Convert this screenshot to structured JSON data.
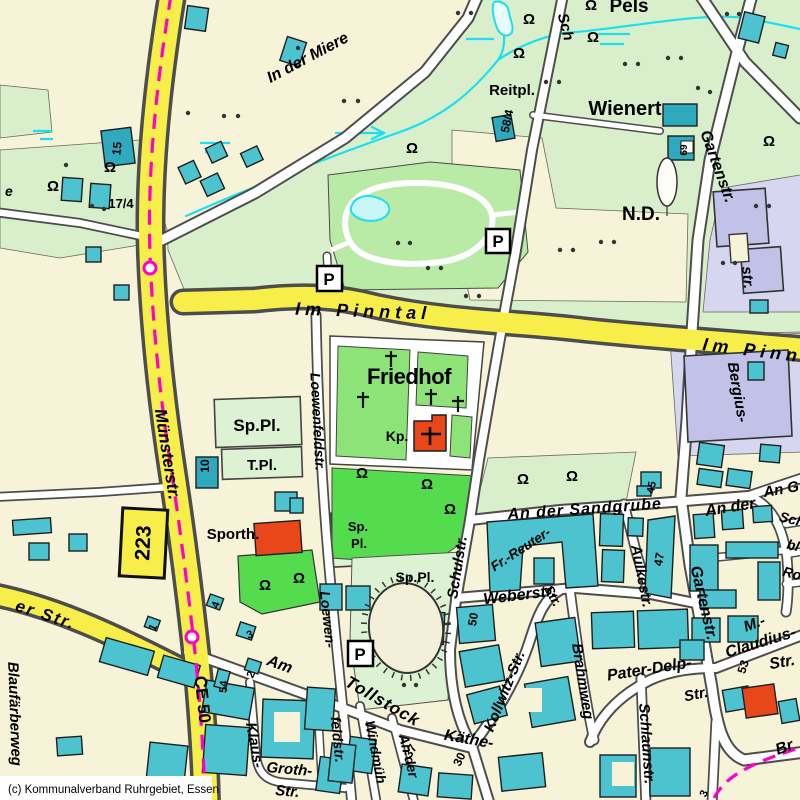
{
  "map": {
    "copyright": "(c) Kommunalverband Ruhrgebiet, Essen",
    "routes": {
      "b223": "223",
      "ce50": "CE 50"
    },
    "icons": {
      "parking": "P",
      "tree": "Ω"
    },
    "colors": {
      "cream": "#f7f3d8",
      "pale_green": "#d9efcb",
      "park_green": "#b9eaa6",
      "mid_green": "#8de378",
      "bright_green": "#55dc4e",
      "teal_building": "#4cc3ce",
      "teal_dark": "#2ea9bd",
      "lavender_area": "#d6d6f0",
      "lavender_building": "#c2c2e8",
      "yellow_road": "#f8ee49",
      "road_casing": "#4d4d4d",
      "magenta": "#ff00cc",
      "cyan": "#19dff0",
      "red_building": "#e8471a"
    },
    "labels": {
      "in_der_miere": "In der Miere",
      "muensterstr": "Münsterstr.",
      "im_pinntal": "Im Pinntal",
      "im_pinn_right": "Im Pinn",
      "er_str": "er Str.",
      "blaufaerberweg": "Blaufärberweg",
      "e_partial": "e",
      "sch_top": "Sch",
      "schulstr": "Schulstr.",
      "kollwitz_str": "Kollwitz-Str.",
      "kaethe": "Käthe-",
      "fr_reuter": "Fr.-Reuter-",
      "fr_reuter_str": "Str.",
      "weberstr": "Weberstr.",
      "an_der_sandgrube": "An der Sandgrube",
      "an_der_2": "An der",
      "an_g": "An G",
      "sch_right": "Sch",
      "bl_right": "bl",
      "ro_right": "Ro",
      "aulkestr": "Aulkestr.",
      "gartenstr": "Gartenstr.",
      "bergius": "Bergius-",
      "str_tail": "str.",
      "brahmweg": "Brahmweg",
      "pater_delp": "Pater-Delp-",
      "pater_delp_str": "Str.",
      "schlaunstr": "Schlaunstr.",
      "m_dash": "M.-",
      "claudius": "Claudius-",
      "claudius_str": "Str.",
      "br_partial": "Br",
      "am": "Am",
      "tollstock": "Tollstock",
      "windmuehle": "Windmüh",
      "an_der_s": "An der",
      "klaus": "Klaus-",
      "groth": "Groth-",
      "klaus_str": "Str.",
      "loewenfeldstr": "Loewenfeldstr.",
      "loewen": "Loewen-",
      "feldstr": "feldstr."
    },
    "areas": {
      "friedhof": "Friedhof",
      "kp": "Kp.",
      "wienert": "Wienert",
      "nd": "N.D.",
      "pels": "Pels",
      "reitpl": "Reitpl.",
      "sppl": "Sp.Pl.",
      "tpl": "T.Pl.",
      "sporth": "Sporth.",
      "sp": "Sp.",
      "pl": "Pl."
    },
    "numbers": {
      "n15": "15",
      "n17_4": "17/4",
      "n58_4": "58/4",
      "n69": "69",
      "n10": "10",
      "n45": "45",
      "n47": "47",
      "n50": "50",
      "n37": "37",
      "n30": "30",
      "n53": "53",
      "n54": "54",
      "n1": "1",
      "n2": "2",
      "n3": "3",
      "n4": "4",
      "n3b": "3"
    }
  }
}
